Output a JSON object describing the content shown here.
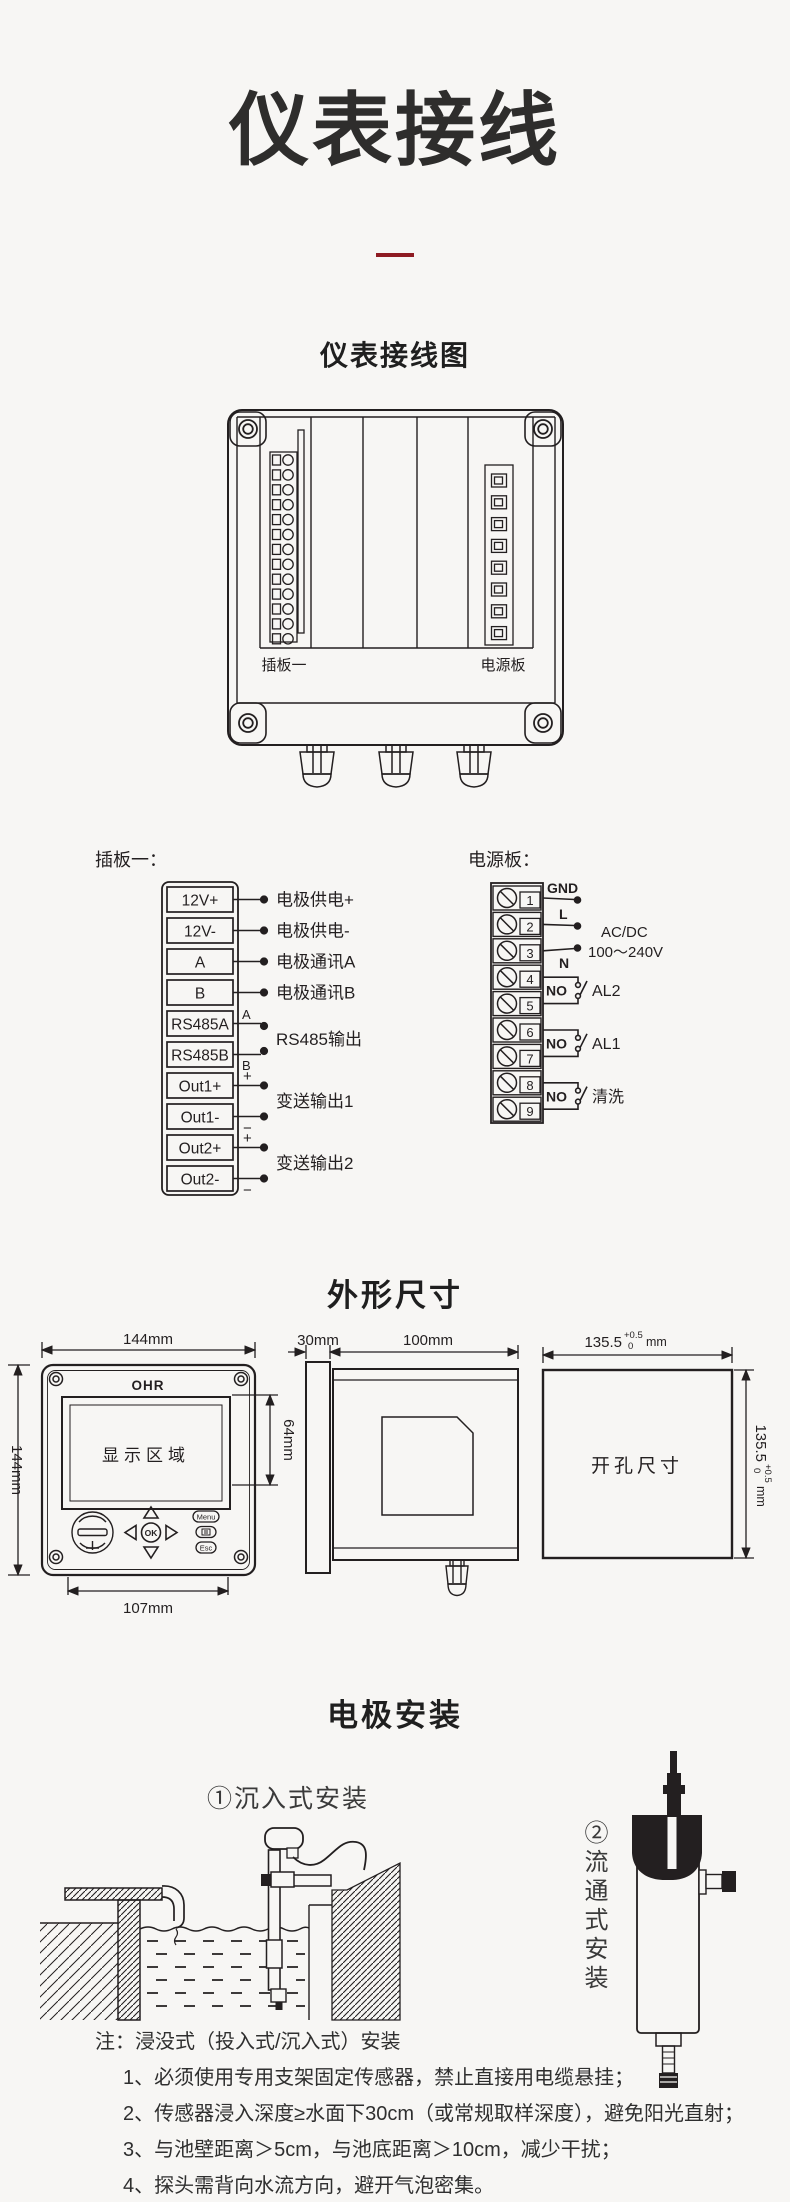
{
  "page": {
    "title": "仪表接线"
  },
  "wiring": {
    "heading": "仪表接线图",
    "board1_label": "插板一",
    "power_label": "电源板"
  },
  "board1": {
    "heading": "插板一：",
    "terminals": [
      "12V+",
      "12V-",
      "A",
      "B",
      "RS485A",
      "RS485B",
      "Out1+",
      "Out1-",
      "Out2+",
      "Out2-"
    ],
    "ann": {
      "a1": "电极供电+",
      "a2": "电极供电-",
      "a3": "电极通讯A",
      "a4": "电极通讯B",
      "a5": "RS485输出",
      "a5a": "A",
      "a5b": "B",
      "a6": "变送输出1",
      "a7": "变送输出2",
      "plus": "+",
      "minus": "−"
    }
  },
  "power": {
    "heading": "电源板：",
    "numbers": [
      "1",
      "2",
      "3",
      "4",
      "5",
      "6",
      "7",
      "8",
      "9"
    ],
    "gnd": "GND",
    "l": "L",
    "n": "N",
    "acdc1": "AC/DC",
    "acdc2": "100～240V",
    "no": "NO",
    "al2": "AL2",
    "al1": "AL1",
    "clean": "清洗"
  },
  "dims": {
    "heading": "外形尺寸",
    "front_w": "144mm",
    "front_h": "144mm",
    "display": "显示区域",
    "display_h": "64mm",
    "bottom_w": "107mm",
    "logo": "OHR",
    "btn_menu": "Menu",
    "btn_ok": "OK",
    "btn_esc": "Esc",
    "side_bezel": "30mm",
    "side_depth": "100mm",
    "cutout_label": "开孔尺寸",
    "cutout_val": "135.5",
    "tol_up": "+0.5",
    "tol_down": "0",
    "unit": "mm"
  },
  "install": {
    "heading": "电极安装",
    "immersion_label": "①沉入式安装",
    "flow_label": "②流通式安装",
    "notes_title": "注：浸没式（投入式/沉入式）安装",
    "notes": [
      "1、必须使用专用支架固定传感器，禁止直接用电缆悬挂；",
      "2、传感器浸入深度≥水面下30cm（或常规取样深度），避免阳光直射；",
      "3、与池壁距离＞5cm，与池底距离＞10cm，减少干扰；",
      "4、探头需背向水流方向，避开气泡密集。"
    ]
  }
}
